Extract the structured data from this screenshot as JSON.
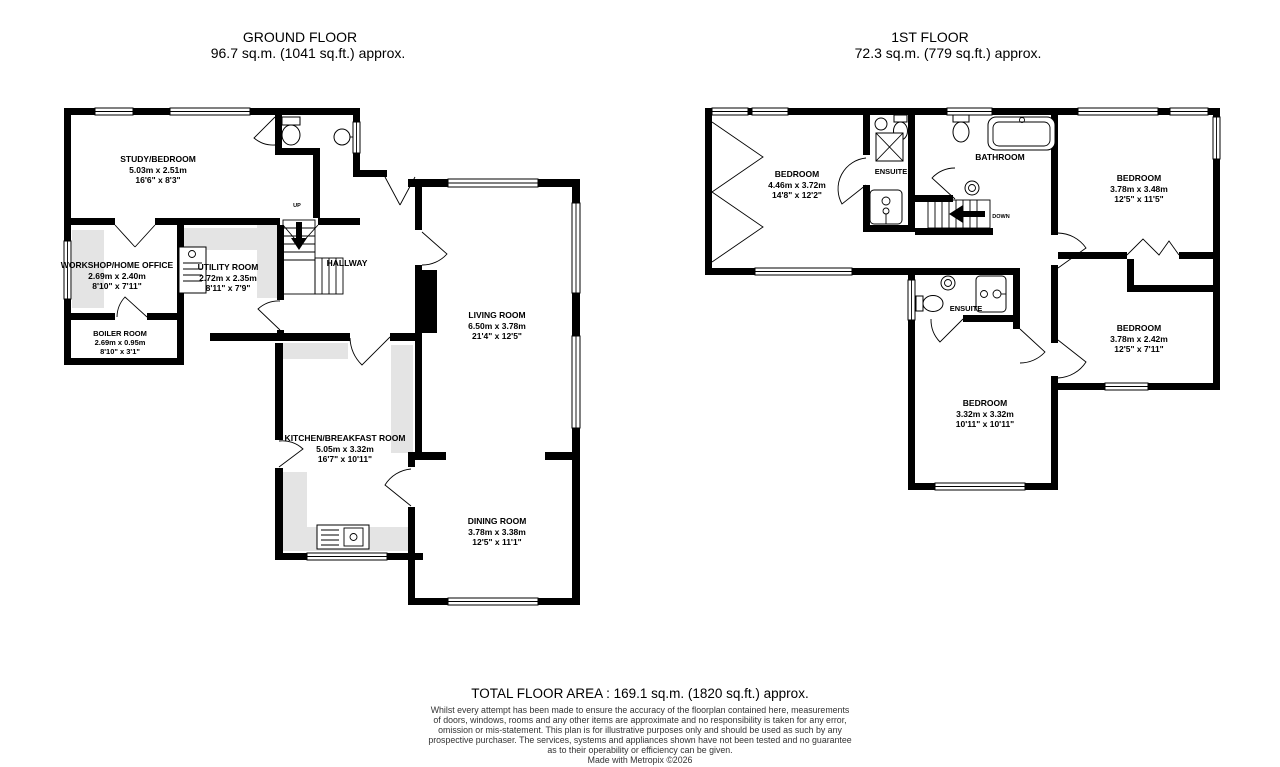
{
  "ground_floor": {
    "title": "GROUND FLOOR",
    "subtitle": "96.7 sq.m. (1041 sq.ft.) approx.",
    "up_label": "UP",
    "rooms": {
      "study": {
        "name": "STUDY/BEDROOM",
        "metric": "5.03m  x 2.51m",
        "imperial": "16'6\"  x 8'3\""
      },
      "workshop": {
        "name": "WORKSHOP/HOME OFFICE",
        "metric": "2.69m  x 2.40m",
        "imperial": "8'10\"  x 7'11\""
      },
      "utility": {
        "name": "UTILITY ROOM",
        "metric": "2.72m  x 2.35m",
        "imperial": "8'11\"  x 7'9\""
      },
      "boiler": {
        "name": "BOILER ROOM",
        "metric": "2.69m  x 0.95m",
        "imperial": "8'10\"  x 3'1\""
      },
      "hallway": {
        "name": "HALLWAY"
      },
      "living": {
        "name": "LIVING ROOM",
        "metric": "6.50m  x 3.78m",
        "imperial": "21'4\"  x 12'5\""
      },
      "kitchen": {
        "name": "KITCHEN/BREAKFAST ROOM",
        "metric": "5.05m  x 3.32m",
        "imperial": "16'7\"  x 10'11\""
      },
      "dining": {
        "name": "DINING ROOM",
        "metric": "3.78m  x 3.38m",
        "imperial": "12'5\"  x 11'1\""
      }
    }
  },
  "first_floor": {
    "title": "1ST FLOOR",
    "subtitle": "72.3 sq.m. (779 sq.ft.) approx.",
    "down_label": "DOWN",
    "rooms": {
      "bedroom1": {
        "name": "BEDROOM",
        "metric": "4.46m  x 3.72m",
        "imperial": "14'8\"  x 12'2\""
      },
      "ensuite1": {
        "name": "ENSUITE"
      },
      "bathroom": {
        "name": "BATHROOM"
      },
      "bedroom2": {
        "name": "BEDROOM",
        "metric": "3.78m  x 3.48m",
        "imperial": "12'5\"  x 11'5\""
      },
      "bedroom3": {
        "name": "BEDROOM",
        "metric": "3.78m  x 2.42m",
        "imperial": "12'5\"  x 7'11\""
      },
      "ensuite2": {
        "name": "ENSUITE"
      },
      "bedroom4": {
        "name": "BEDROOM",
        "metric": "3.32m  x 3.32m",
        "imperial": "10'11\"  x 10'11\""
      }
    }
  },
  "footer": {
    "total_area": "TOTAL FLOOR AREA : 169.1 sq.m. (1820 sq.ft.) approx.",
    "disclaimer_lines": [
      "Whilst every attempt has been made to ensure the accuracy of the floorplan contained here, measurements",
      "of doors, windows, rooms and any other items are approximate and no responsibility is taken for any error,",
      "omission or mis-statement. This plan is for illustrative purposes only and should be used as such by any",
      "prospective purchaser. The services, systems and appliances shown have not been tested and no guarantee",
      "as to their operability or efficiency can be given.",
      "Made with Metropix ©2026"
    ]
  }
}
